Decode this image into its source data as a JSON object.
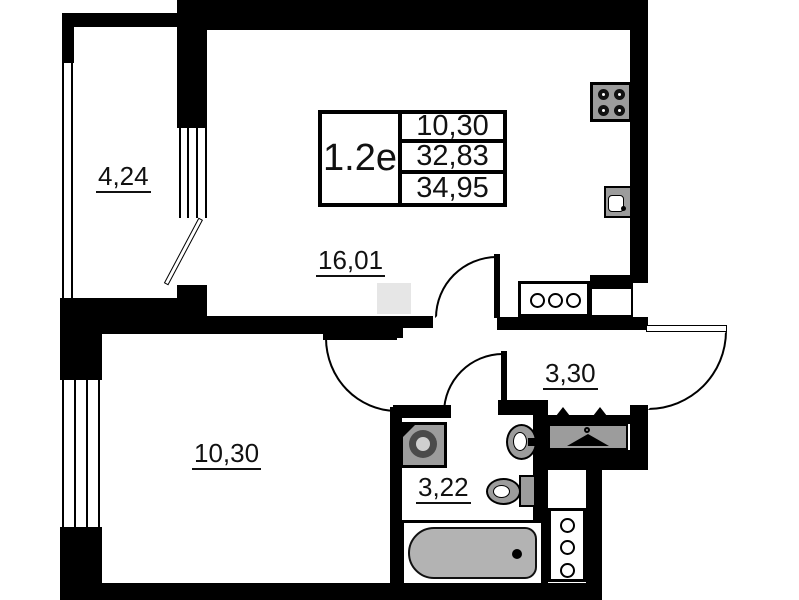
{
  "title_block": {
    "unit": "1.2e",
    "values": [
      "10,30",
      "32,83",
      "34,95"
    ]
  },
  "rooms": {
    "balcony": {
      "area": "4,24"
    },
    "living_kitchen": {
      "area": "16,01"
    },
    "hallway": {
      "area": "3,30"
    },
    "bedroom": {
      "area": "10,30"
    },
    "bathroom": {
      "area": "3,22"
    }
  },
  "fixtures": [
    "stove-icon",
    "kitchen-sink-icon",
    "kitchen-counter-icon",
    "entrance-door-icon",
    "washing-machine-icon",
    "washbasin-icon",
    "toilet-icon",
    "bathtub-icon",
    "wardrobe-hanger-icon",
    "service-cabinet-icon",
    "window-icon",
    "door-arc-icon"
  ],
  "colors": {
    "wall": "#000000",
    "fixture_fill": "#9c9c9c",
    "tub_fill": "#b3b3b3",
    "ghost": "#e6e6e6",
    "background": "#ffffff"
  }
}
